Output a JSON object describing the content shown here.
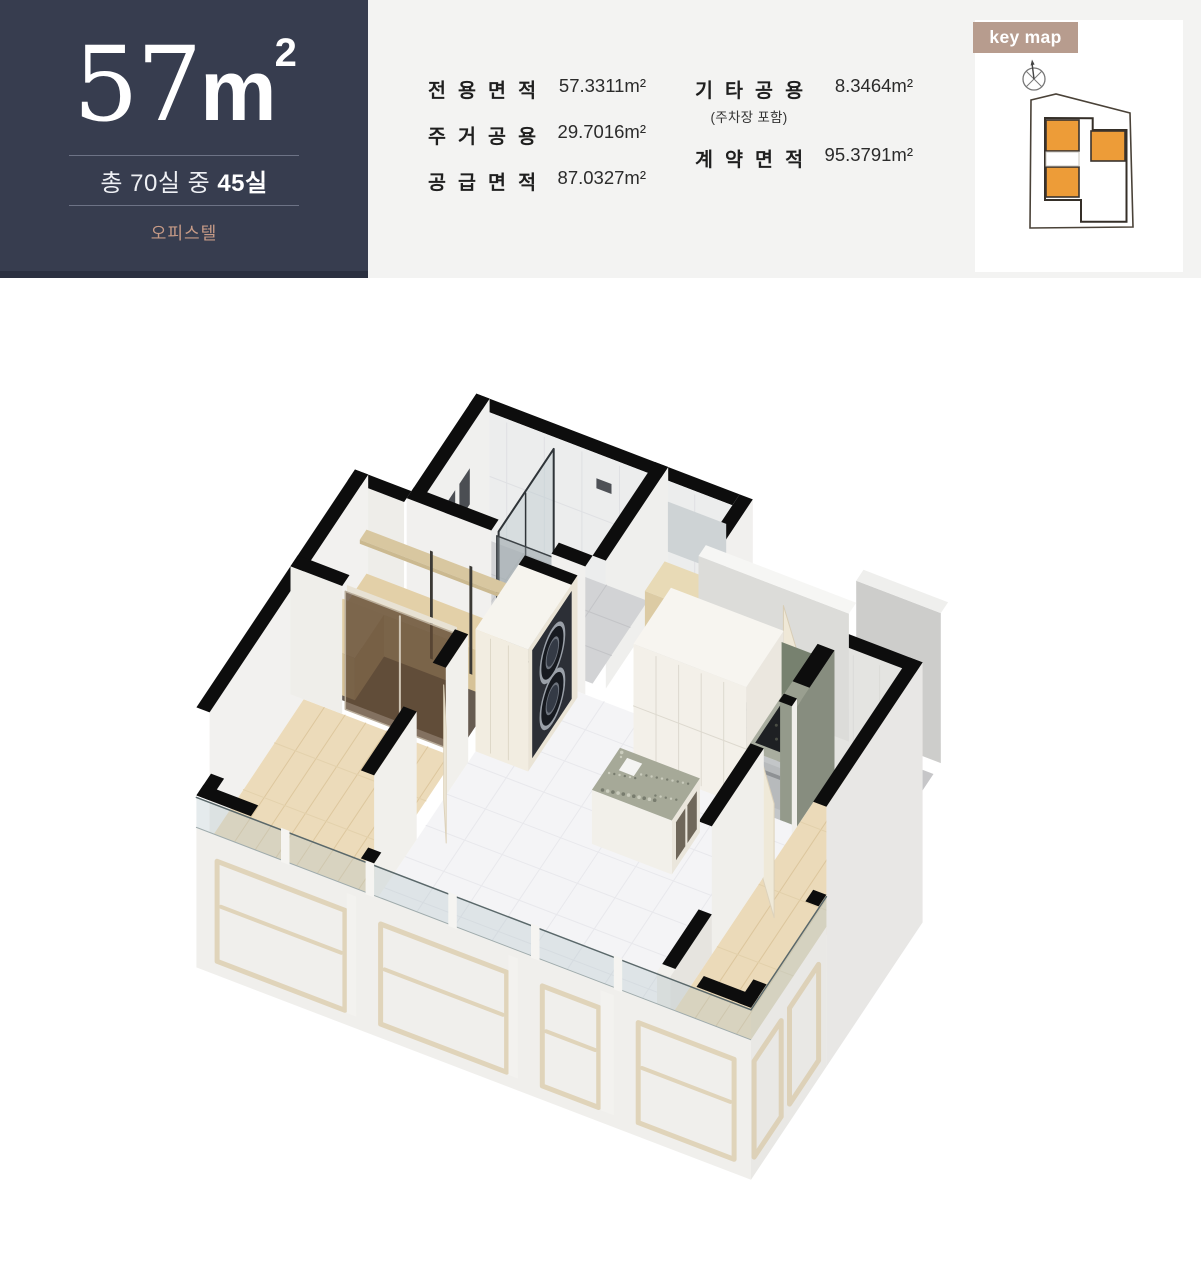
{
  "header": {
    "unit": {
      "size_value": "57",
      "size_unit": "m",
      "size_sup": "2",
      "rooms_prefix": "총 70실 중 ",
      "rooms_bold": "45실",
      "type_label": "오피스텔"
    },
    "areas": {
      "col1": [
        {
          "label": "전용면적",
          "value": "57.3311m²"
        },
        {
          "label": "주거공용",
          "value": "29.7016m²"
        },
        {
          "label": "공급면적",
          "value": "87.0327m²"
        }
      ],
      "col2": [
        {
          "label": "기타공용",
          "sublabel": "(주차장 포함)",
          "value": "8.3464m²"
        },
        {
          "label": "계약면적",
          "sublabel": "",
          "value": "95.3791m²"
        }
      ]
    },
    "keymap": {
      "label": "key map",
      "highlight_color": "#ed9c38"
    }
  },
  "floor_plan": {
    "description": "3D isometric cutaway rendering of the 57m² officetel unit",
    "rooms": [
      "bathroom with glass shower",
      "powder room",
      "entry",
      "dressing room",
      "bedroom",
      "bedroom",
      "living room",
      "kitchen with island",
      "stacked washer-dryer",
      "balcony glazing"
    ]
  },
  "colors": {
    "navy": "#373d4f",
    "accent_tan": "#c79b87",
    "keymap_label_bg": "#b79c8e",
    "keymap_highlight": "#ed9c38",
    "wall_black": "#0d0d0d"
  }
}
